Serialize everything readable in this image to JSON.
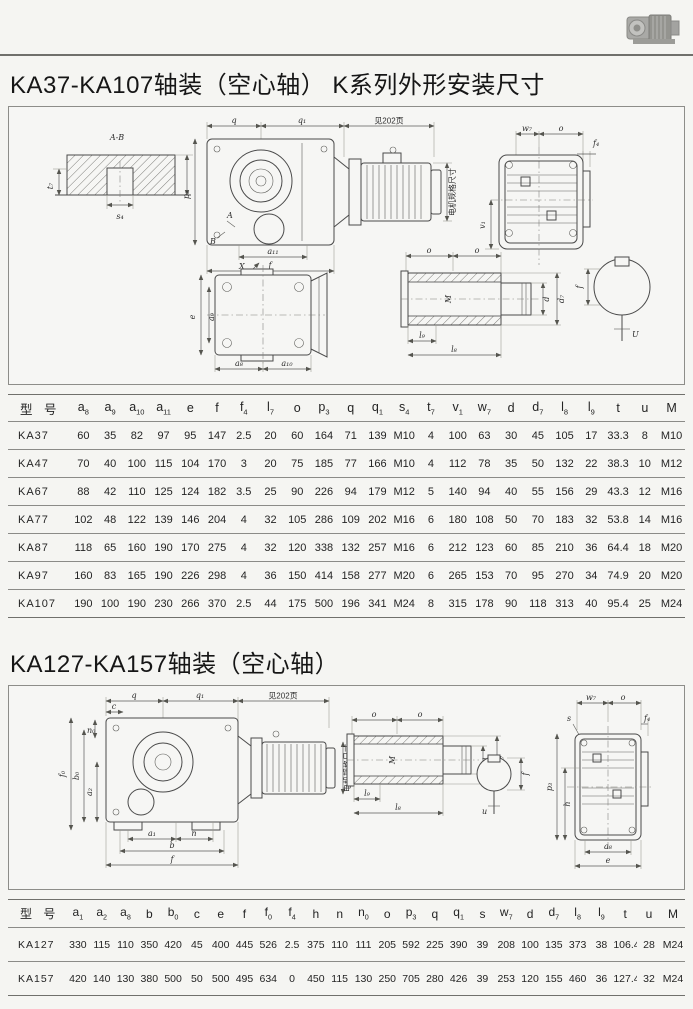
{
  "titles": {
    "section1": "KA37-KA107轴装（空心轴）  K系列外形安装尺寸",
    "section2": "KA127-KA157轴装（空心轴）"
  },
  "table1": {
    "columns": [
      {
        "b": "型 号",
        "s": ""
      },
      {
        "b": "a",
        "s": "8"
      },
      {
        "b": "a",
        "s": "9"
      },
      {
        "b": "a",
        "s": "10"
      },
      {
        "b": "a",
        "s": "11"
      },
      {
        "b": "e",
        "s": ""
      },
      {
        "b": "f",
        "s": ""
      },
      {
        "b": "f",
        "s": "4"
      },
      {
        "b": "l",
        "s": "7"
      },
      {
        "b": "o",
        "s": ""
      },
      {
        "b": "p",
        "s": "3"
      },
      {
        "b": "q",
        "s": ""
      },
      {
        "b": "q",
        "s": "1"
      },
      {
        "b": "s",
        "s": "4"
      },
      {
        "b": "t",
        "s": "7"
      },
      {
        "b": "v",
        "s": "1"
      },
      {
        "b": "w",
        "s": "7"
      },
      {
        "b": "d",
        "s": ""
      },
      {
        "b": "d",
        "s": "7"
      },
      {
        "b": "l",
        "s": "8"
      },
      {
        "b": "l",
        "s": "9"
      },
      {
        "b": "t",
        "s": ""
      },
      {
        "b": "u",
        "s": ""
      },
      {
        "b": "M",
        "s": ""
      }
    ],
    "rows": [
      {
        "model": "KA37",
        "values": [
          "60",
          "35",
          "82",
          "97",
          "95",
          "147",
          "2.5",
          "20",
          "60",
          "164",
          "71",
          "139",
          "M10",
          "4",
          "100",
          "63",
          "30",
          "45",
          "105",
          "17",
          "33.3",
          "8",
          "M10"
        ]
      },
      {
        "model": "KA47",
        "values": [
          "70",
          "40",
          "100",
          "115",
          "104",
          "170",
          "3",
          "20",
          "75",
          "185",
          "77",
          "166",
          "M10",
          "4",
          "112",
          "78",
          "35",
          "50",
          "132",
          "22",
          "38.3",
          "10",
          "M12"
        ]
      },
      {
        "model": "KA67",
        "values": [
          "88",
          "42",
          "110",
          "125",
          "124",
          "182",
          "3.5",
          "25",
          "90",
          "226",
          "94",
          "179",
          "M12",
          "5",
          "140",
          "94",
          "40",
          "55",
          "156",
          "29",
          "43.3",
          "12",
          "M16"
        ]
      },
      {
        "model": "KA77",
        "values": [
          "102",
          "48",
          "122",
          "139",
          "146",
          "204",
          "4",
          "32",
          "105",
          "286",
          "109",
          "202",
          "M16",
          "6",
          "180",
          "108",
          "50",
          "70",
          "183",
          "32",
          "53.8",
          "14",
          "M16"
        ]
      },
      {
        "model": "KA87",
        "values": [
          "118",
          "65",
          "160",
          "190",
          "170",
          "275",
          "4",
          "32",
          "120",
          "338",
          "132",
          "257",
          "M16",
          "6",
          "212",
          "123",
          "60",
          "85",
          "210",
          "36",
          "64.4",
          "18",
          "M20"
        ]
      },
      {
        "model": "KA97",
        "values": [
          "160",
          "83",
          "165",
          "190",
          "226",
          "298",
          "4",
          "36",
          "150",
          "414",
          "158",
          "277",
          "M20",
          "6",
          "265",
          "153",
          "70",
          "95",
          "270",
          "34",
          "74.9",
          "20",
          "M20"
        ]
      },
      {
        "model": "KA107",
        "values": [
          "190",
          "100",
          "190",
          "230",
          "266",
          "370",
          "2.5",
          "44",
          "175",
          "500",
          "196",
          "341",
          "M24",
          "8",
          "315",
          "178",
          "90",
          "118",
          "313",
          "40",
          "95.4",
          "25",
          "M24"
        ]
      }
    ]
  },
  "table2": {
    "columns": [
      {
        "b": "型 号",
        "s": ""
      },
      {
        "b": "a",
        "s": "1"
      },
      {
        "b": "a",
        "s": "2"
      },
      {
        "b": "a",
        "s": "8"
      },
      {
        "b": "b",
        "s": ""
      },
      {
        "b": "b",
        "s": "0"
      },
      {
        "b": "c",
        "s": ""
      },
      {
        "b": "e",
        "s": ""
      },
      {
        "b": "f",
        "s": ""
      },
      {
        "b": "f",
        "s": "0"
      },
      {
        "b": "f",
        "s": "4"
      },
      {
        "b": "h",
        "s": ""
      },
      {
        "b": "n",
        "s": ""
      },
      {
        "b": "n",
        "s": "0"
      },
      {
        "b": "o",
        "s": ""
      },
      {
        "b": "p",
        "s": "3"
      },
      {
        "b": "q",
        "s": ""
      },
      {
        "b": "q",
        "s": "1"
      },
      {
        "b": "s",
        "s": ""
      },
      {
        "b": "w",
        "s": "7"
      },
      {
        "b": "d",
        "s": ""
      },
      {
        "b": "d",
        "s": "7"
      },
      {
        "b": "l",
        "s": "8"
      },
      {
        "b": "l",
        "s": "9"
      },
      {
        "b": "t",
        "s": ""
      },
      {
        "b": "u",
        "s": ""
      },
      {
        "b": "M",
        "s": ""
      }
    ],
    "rows": [
      {
        "model": "KA127",
        "values": [
          "330",
          "115",
          "110",
          "350",
          "420",
          "45",
          "400",
          "445",
          "526",
          "2.5",
          "375",
          "110",
          "111",
          "205",
          "592",
          "225",
          "390",
          "39",
          "208",
          "100",
          "135",
          "373",
          "38",
          "106.4",
          "28",
          "M24"
        ]
      },
      {
        "model": "KA157",
        "values": [
          "420",
          "140",
          "130",
          "380",
          "500",
          "50",
          "500",
          "495",
          "634",
          "0",
          "450",
          "115",
          "130",
          "250",
          "705",
          "280",
          "426",
          "39",
          "253",
          "120",
          "155",
          "460",
          "36",
          "127.4",
          "32",
          "M24"
        ]
      }
    ]
  },
  "dwg1": {
    "ab": "A-B",
    "t7": "t₇",
    "s4": "s₄",
    "q": "q",
    "q1": "q₁",
    "see": "见202页",
    "p3": "p₃",
    "a_mark": "A",
    "b_mark": "B",
    "a11": "a₁₁",
    "f": "f",
    "x": "X",
    "motor": "电机规格尺寸",
    "w7": "w₇",
    "o": "o",
    "f4": "f₄",
    "v1": "v₁",
    "e": "e",
    "a9": "a₉",
    "a8": "a₈",
    "a10": "a₁₀",
    "m": "M",
    "d": "d",
    "d7": "d₇",
    "l8": "l₈",
    "l9": "l₉",
    "fc": "f",
    "u": "U"
  },
  "dwg2": {
    "q": "q",
    "q1": "q₁",
    "see": "见202页",
    "c": "c",
    "n0": "n₀",
    "f0": "f₀",
    "b0": "b₀",
    "a2": "a₂",
    "a1": "a₁",
    "n": "n",
    "b": "b",
    "f": "f",
    "motor": "电机规格尺寸",
    "o": "o",
    "m": "M",
    "d": "d",
    "d7": "d₇",
    "l8": "l₈",
    "l9": "l₉",
    "u": "u",
    "fc": "f",
    "w7": "w₇",
    "o2": "o",
    "s": "s",
    "f4": "f₄",
    "p3": "p₃",
    "h": "h",
    "a8": "a₈",
    "e": "e"
  }
}
